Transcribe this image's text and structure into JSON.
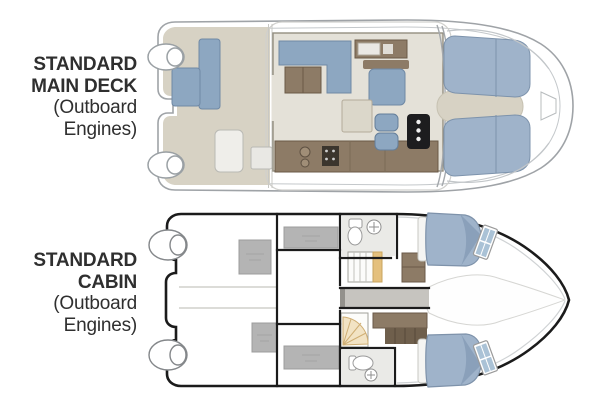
{
  "page": {
    "background": "#ffffff"
  },
  "labels": {
    "main_deck": {
      "title_line1": "STANDARD",
      "title_line2": "MAIN DECK",
      "subtitle_line1": "(Outboard",
      "subtitle_line2": "Engines)"
    },
    "cabin": {
      "title_line1": "STANDARD",
      "title_line2": "CABIN",
      "subtitle_line1": "(Outboard",
      "subtitle_line2": "Engines)"
    }
  },
  "palette": {
    "text_color": "#2f2f2f",
    "hull_line": "#9fa3a7",
    "hull_line_dark": "#1b1b1b",
    "deck_beige": "#d7d2c4",
    "floor_light": "#e4e1d8",
    "furniture_blue": "#8da7c1",
    "bed_blue": "#9fb3ca",
    "furniture_brown": "#8d7b66",
    "furniture_brown_dark": "#6f5f4c",
    "console_black": "#1d1d1f",
    "storage_gray": "#b4b4b4",
    "corridor_gray": "#c6c4bf",
    "stair_tan": "#e4c07d",
    "window_blue": "#aac2d6"
  },
  "diagrams": [
    {
      "id": "main-deck",
      "features": [
        "outboard-engines",
        "swim-platform",
        "cockpit-seating",
        "cockpit-table",
        "salon-dinette",
        "galley",
        "companion-seat",
        "helm-seats",
        "helm-console",
        "bow-sun-pads",
        "bow-walkway"
      ]
    },
    {
      "id": "cabin",
      "features": [
        "outboard-engines",
        "storage-compartments",
        "midship-berths",
        "port-head",
        "starboard-head",
        "stairs",
        "companionway-corridor",
        "island-berths",
        "hull-windows",
        "bow-tunnel"
      ]
    }
  ]
}
